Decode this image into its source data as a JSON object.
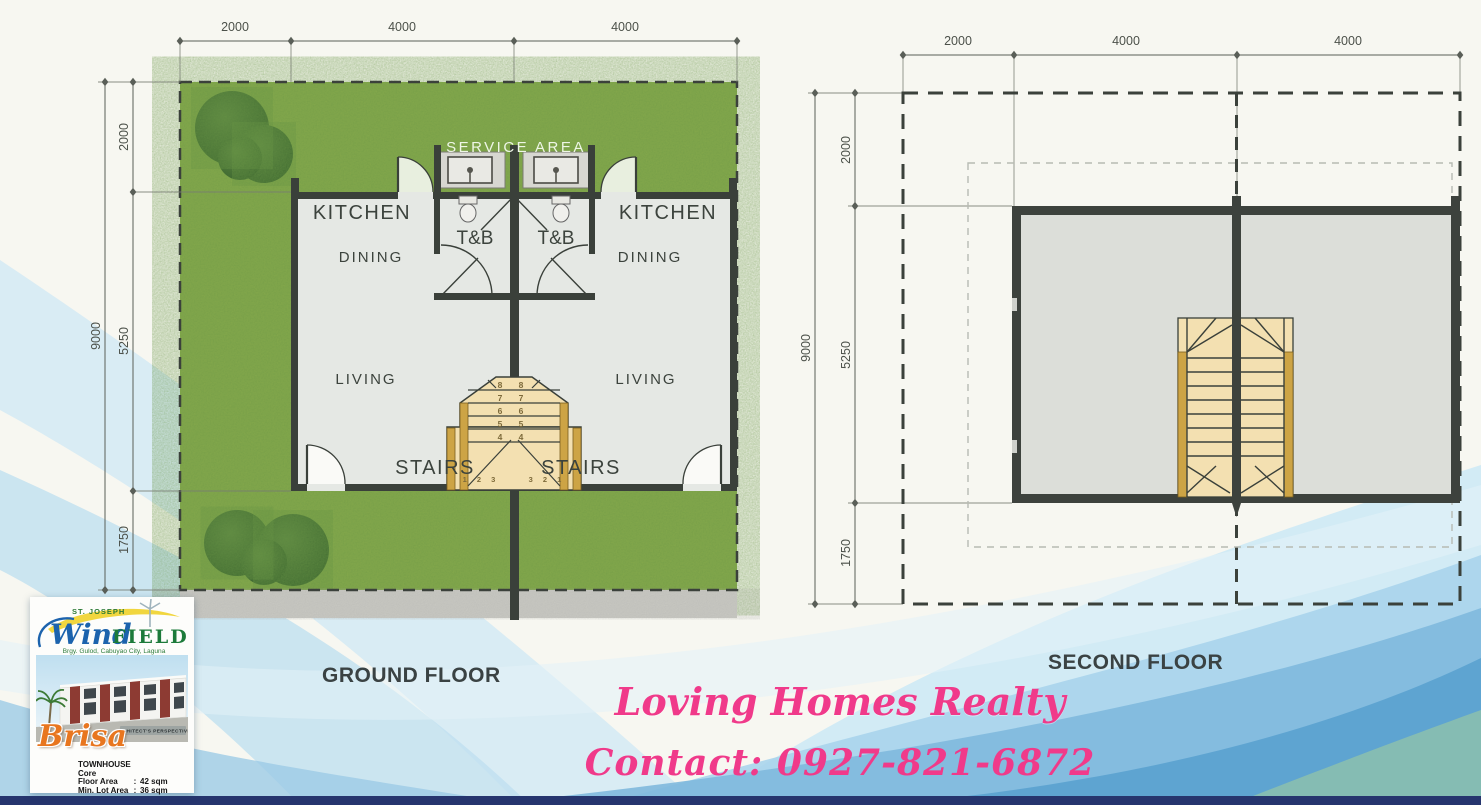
{
  "colors": {
    "paper": "#f7f7f1",
    "lawn": "#87aa4c",
    "bush": "#47763a",
    "wall": "#3a403a",
    "floor": "#e5e8e4",
    "slab": "#dcded9",
    "sidewalk": "#cbcbc5",
    "stair_wood": "#f3e0b1",
    "stair_rail": "#cda445",
    "dim_line": "#5a5f58",
    "label_text": "#3c433d",
    "service_text": "#eef6e6",
    "wave_pale": "#cfe8f4",
    "wave_mid": "#a9d4ec",
    "wave_deep": "#7fb9dd",
    "wave_deepest": "#57a0cf",
    "wave_teal": "#8fc2ab",
    "bottom_bar": "#26356e",
    "watermark_pink": "#f03a8a",
    "brand_blue": "#1c63ad",
    "brand_green": "#1c7a3a",
    "brisa_orange": "#e8761f",
    "maroon": "#8d3b33"
  },
  "ground_floor": {
    "title": "GROUND FLOOR",
    "dims_top": [
      "2000",
      "4000",
      "4000"
    ],
    "dim_total_left": "9000",
    "dims_left": [
      "2000",
      "5250",
      "1750"
    ],
    "labels": {
      "service_area": "SERVICE AREA",
      "kitchen": "KITCHEN",
      "dining": "DINING",
      "tb": "T&B",
      "living": "LIVING",
      "stairs": "STAIRS"
    },
    "stair_treads": {
      "rows": [
        "8 8",
        "7 7",
        "6 6",
        "5 5",
        "4 4"
      ],
      "bottom_left": "1 2 3",
      "bottom_right": "3 2 1"
    }
  },
  "second_floor": {
    "title": "SECOND FLOOR",
    "dims_top": [
      "2000",
      "4000",
      "4000"
    ],
    "dim_total_left": "9000",
    "dims_left": [
      "2000",
      "5250",
      "1750"
    ]
  },
  "watermark": {
    "line1": "Loving Homes Realty",
    "line2": "Contact: 0927-821-6872"
  },
  "card": {
    "project_prefix": "ST. JOSEPH",
    "brand_script": "Wind",
    "brand_caps": "FIELD",
    "address": "Brgy. Gulod, Cabuyao City, Laguna",
    "perspective_note": "ARCHITECT'S PERSPECTIVE",
    "model_name": "Brisa",
    "specs": {
      "type": "TOWNHOUSE",
      "variant": "Core",
      "floor_area_label": "Floor Area",
      "separator": ":",
      "floor_area_value": "42 sqm",
      "lot_area_label": "Min. Lot Area",
      "lot_area_value": "36 sqm"
    }
  }
}
